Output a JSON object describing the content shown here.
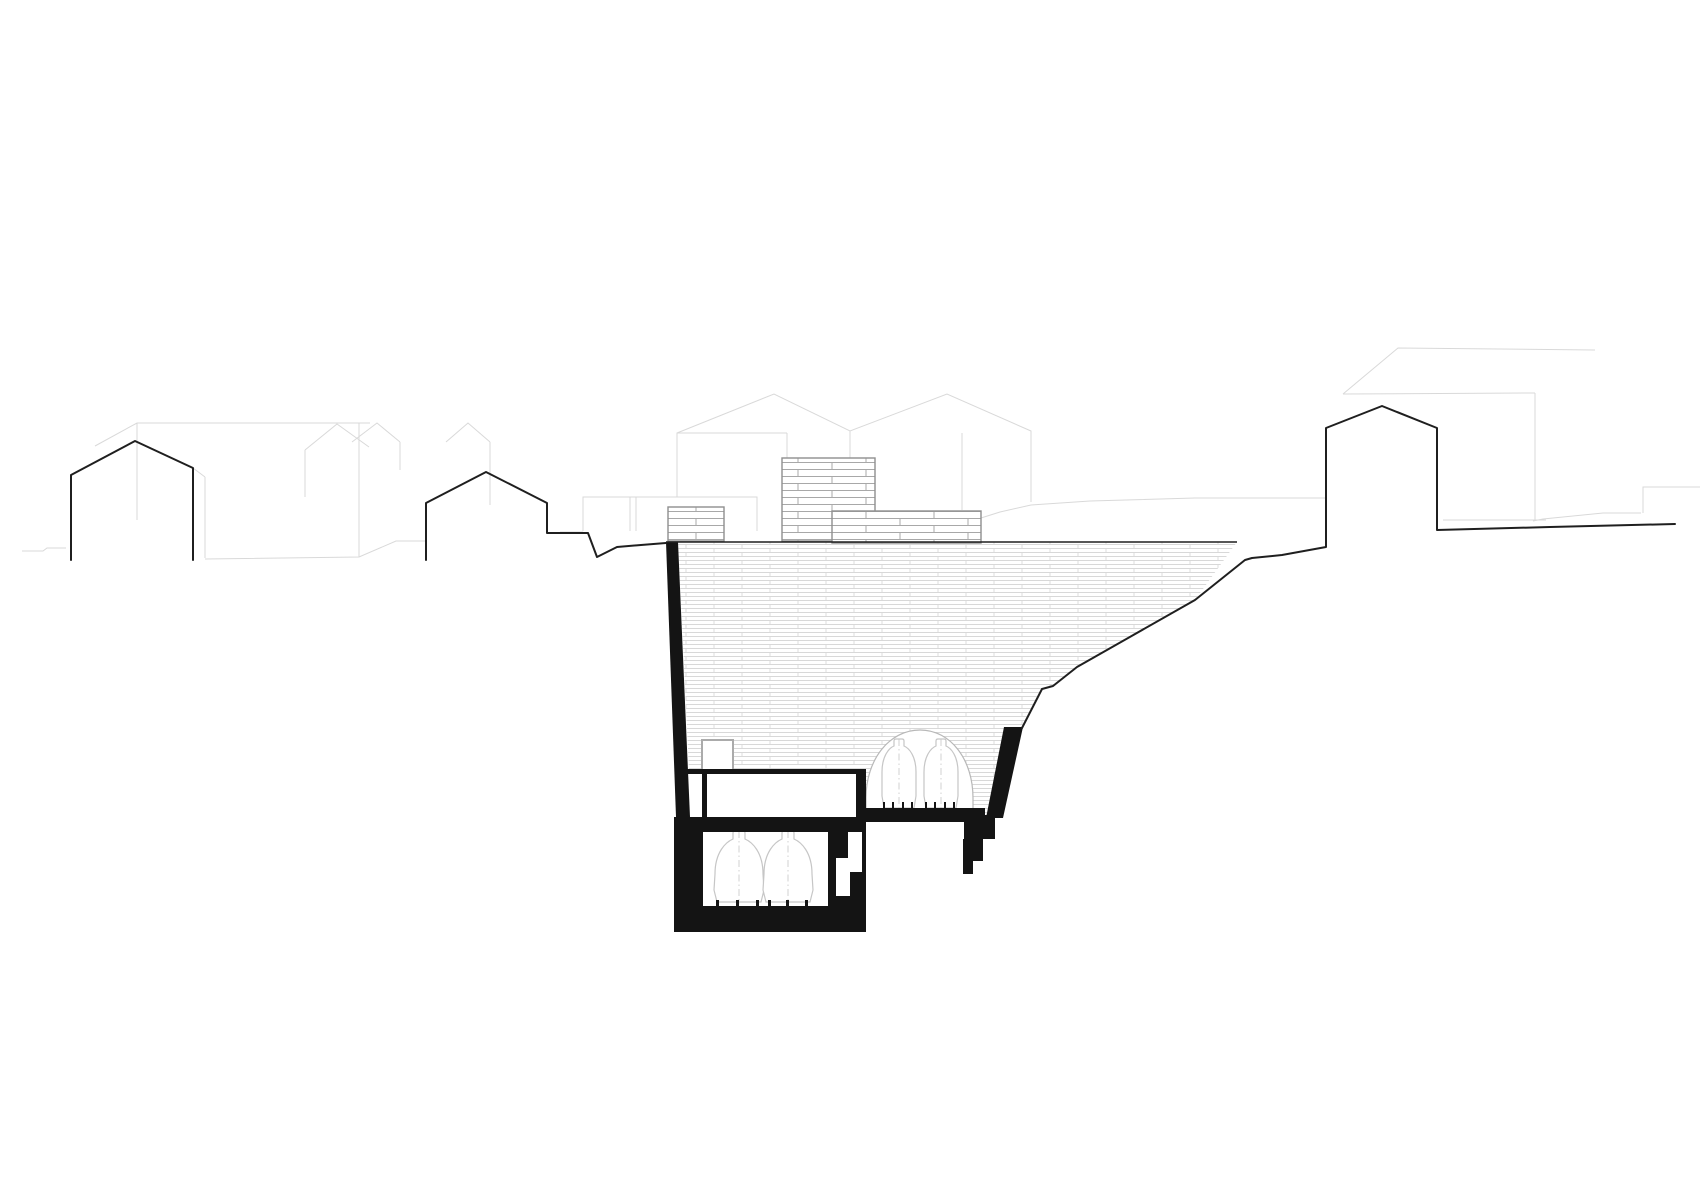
{
  "meta": {
    "title": "Architectural site section drawing — underground vaulted cellar with storage vessels cut into a village hillside",
    "drawing_type": "section-elevation",
    "visible_text": "none"
  },
  "canvas": {
    "width": 1700,
    "height": 1201,
    "background": "#ffffff"
  },
  "palette": {
    "paper": "#ffffff",
    "cut_poche": "#141414",
    "terrain_line": "#1f1f1f",
    "background_line": "#d9d9d9",
    "masonry_border": "#8f8f8f",
    "masonry_line": "#a8a8a8",
    "hatch_line": "#d8d8d8",
    "vessel_line": "#c6c6c6",
    "vault_line": "#b8b8b8",
    "shaft_border": "#ababab"
  },
  "scene": {
    "background_buildings": {
      "left_cluster_gable_peaks": 3,
      "center_twin_gable_peaks": 2,
      "right_perspective_boxes": 2
    },
    "silhouette_houses": {
      "count": 3,
      "positions": [
        "left of section",
        "immediately left of excavation",
        "right of excavation"
      ]
    },
    "excavation": {
      "fill": "coursed masonry hatch",
      "levels": 2,
      "vaulted_chamber_vessels": 2,
      "lower_cellar_vessels": 2,
      "surface_masonry_boxes": 3,
      "shaft_box": 1
    }
  }
}
